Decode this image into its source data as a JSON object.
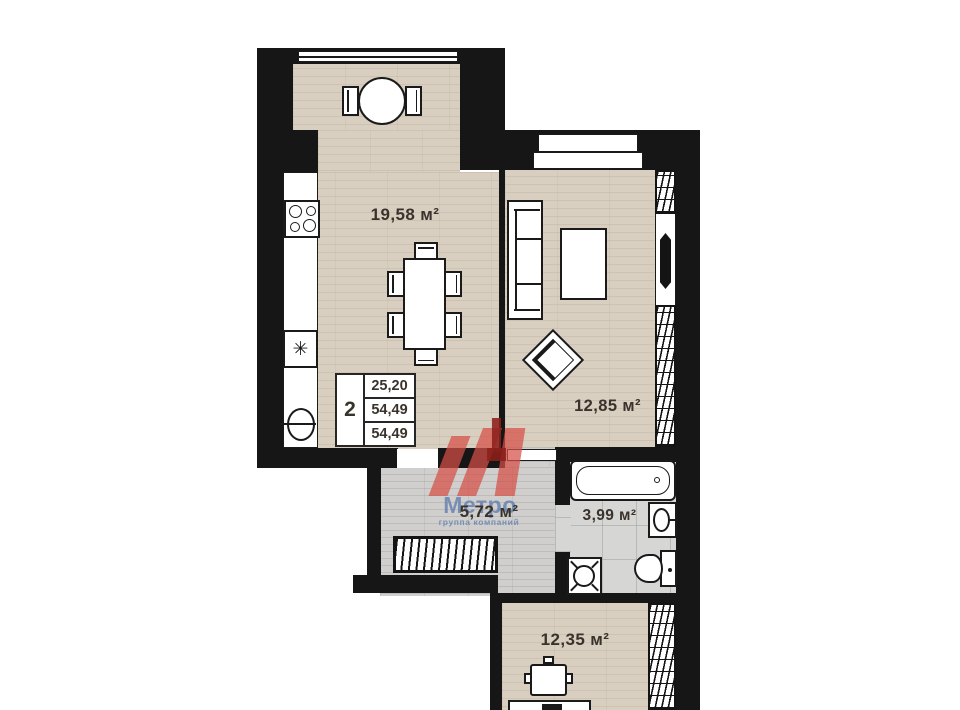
{
  "plan": {
    "type": "apartment-floor-plan",
    "rooms": {
      "kitchen_living": {
        "area_label": "19,58 м²"
      },
      "bedroom": {
        "area_label": "12,85 м²"
      },
      "hallway": {
        "area_label": "5,72 м²"
      },
      "bathroom": {
        "area_label": "3,99 м²"
      },
      "room_below": {
        "area_label": "12,35 м²"
      }
    },
    "info_box": {
      "rooms_count": "2",
      "living_area": "25,20",
      "total_area": "54,49",
      "total_area_with_balcony": "54,49"
    },
    "watermark": {
      "brand": "Метро",
      "tagline": "группа компаний"
    },
    "symbols": {
      "kitchen_vent": "✳"
    },
    "colors": {
      "wall": "#161616",
      "floor_wood": "#d9cfc0",
      "floor_gray_wood": "#d0cfcd",
      "floor_tile": "#d6d6d4",
      "fixture_fill": "#ffffff",
      "label_text": "#3a332c",
      "watermark_red": "#d64e46",
      "watermark_dark_red": "#8c201a",
      "watermark_blue": "#607eb0"
    }
  }
}
